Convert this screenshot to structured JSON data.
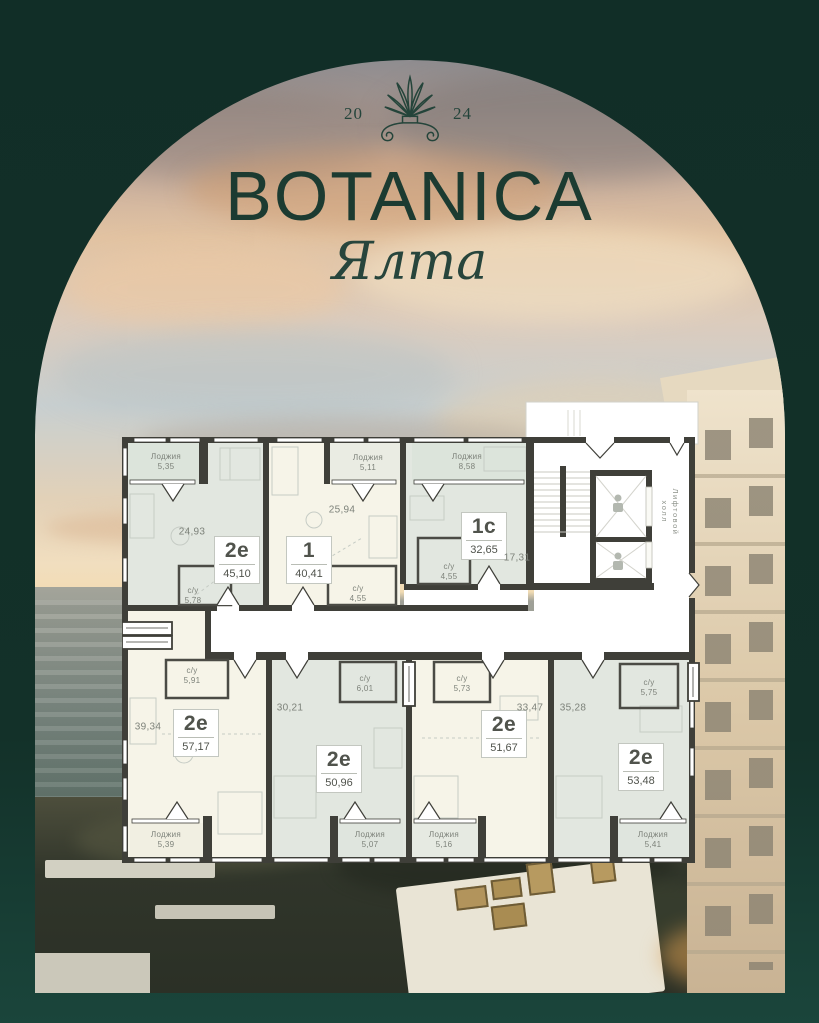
{
  "branding": {
    "year_left": "20",
    "year_right": "24",
    "title": "BOTANICA",
    "subtitle": "Ялта"
  },
  "labels": {
    "loggia": "Лоджия",
    "wc": "с/у",
    "elevator_hall_lines": [
      "Лифтовой",
      "холл"
    ]
  },
  "colors": {
    "frame_green": "#123029",
    "brand_green": "#1c3b31",
    "wall_dark": "#3f3f39",
    "apartment_sage": "#e2e7e0",
    "apartment_cream": "#f6f4e8"
  },
  "apartments": [
    {
      "type": "2е",
      "total_area": "45,10",
      "main_area": "24,93",
      "wc_area": "5,78",
      "loggia_area": "5,35"
    },
    {
      "type": "1",
      "total_area": "40,41",
      "main_area": "25,94",
      "wc_area": "4,55",
      "loggia_area": "5,11"
    },
    {
      "type": "1с",
      "total_area": "32,65",
      "main_area": "17,31",
      "wc_area": "4,55",
      "loggia_area": "8,58"
    },
    {
      "type": "2е",
      "total_area": "57,17",
      "main_area": "39,34",
      "wc_area": "5,91",
      "loggia_area": "5,39"
    },
    {
      "type": "2е",
      "total_area": "50,96",
      "main_area": "30,21",
      "wc_area": "6,01",
      "loggia_area": "5,07"
    },
    {
      "type": "2е",
      "total_area": "51,67",
      "main_area": "33,47",
      "wc_area": "5,73",
      "loggia_area": "5,16"
    },
    {
      "type": "2е",
      "total_area": "53,48",
      "main_area": "35,28",
      "wc_area": "5,75",
      "loggia_area": "5,41"
    }
  ]
}
